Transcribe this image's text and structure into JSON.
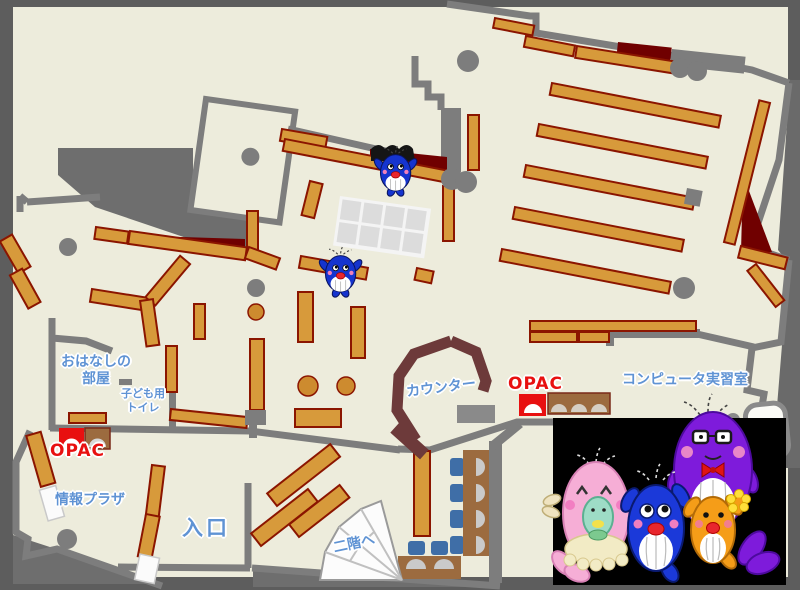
{
  "map": {
    "title": "library-floor-map",
    "labels": {
      "ohanashi_room": {
        "line1": "おはなしの",
        "line2": "部屋"
      },
      "kids_toilet": {
        "line1": "子ども用",
        "line2": "トイレ"
      },
      "opac_left": "OPAC",
      "info_plaza": "情報プラザ",
      "entrance": "入口",
      "stairs_up": "二階へ",
      "counter": "カウンター",
      "opac_right": "OPAC",
      "computer_room": "コンピュータ実習室"
    },
    "colors": {
      "floor": "#edecdc",
      "outer_gray": "#6a6a6a",
      "wall_gray": "#7d7d7d",
      "shelf_orange": "#d79a3b",
      "shelf_outline": "#8b1500",
      "dark_red_area": "#700000",
      "counter_brown": "#6d3a3a",
      "desk_brown": "#9c6b3f",
      "chair_blue": "#3f6ea7",
      "label_blue": "#5f93d4",
      "opac_red": "#e81010",
      "mascot_background": "#000000"
    },
    "mascots": {
      "small_blue_whales_count": 2,
      "family": [
        "pink-mother-whale-with-baby",
        "blue-child-whale",
        "purple-father-whale",
        "orange-small-whale"
      ]
    }
  }
}
